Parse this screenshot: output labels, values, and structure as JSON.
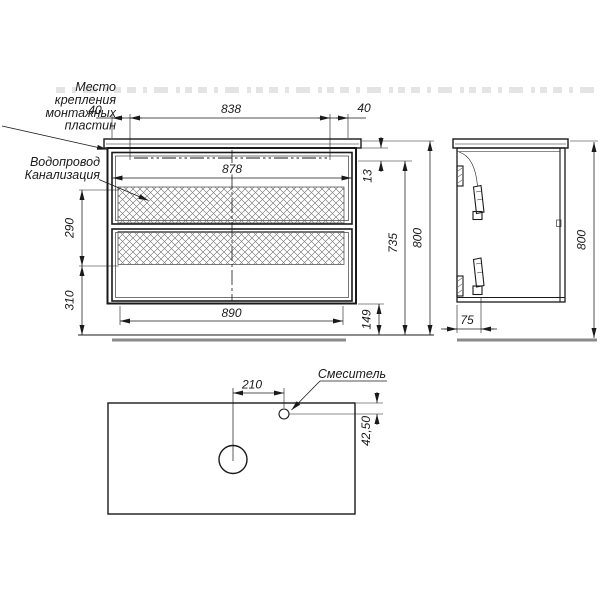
{
  "drawing": {
    "front_view": {
      "dim_top_left": "40",
      "dim_top_center": "838",
      "dim_top_right": "40",
      "dim_inner_width": "878",
      "dim_top_gap": "13",
      "dim_left_upper": "290",
      "dim_left_lower": "310",
      "dim_bottom_width": "890",
      "dim_right_inner_height": "735",
      "dim_right_total_height": "800",
      "dim_right_bottom_gap": "149"
    },
    "side_view": {
      "dim_plate_depth": "75",
      "dim_total_height": "800"
    },
    "plan_view": {
      "dim_mixer_offset": "210",
      "dim_mixer_inset": "42,50",
      "label_mixer": "Смеситель"
    },
    "callouts": {
      "mounting_plates": {
        "line1": "Место",
        "line2": "крепления",
        "line3": "монтажных",
        "line4": "пластин"
      },
      "plumbing": {
        "line1": "Водопровод",
        "line2": "Канализация"
      }
    },
    "colors": {
      "line": "#1a1a1a",
      "floor_shadow": "#8a8a8a",
      "hatch": "#666666"
    }
  }
}
